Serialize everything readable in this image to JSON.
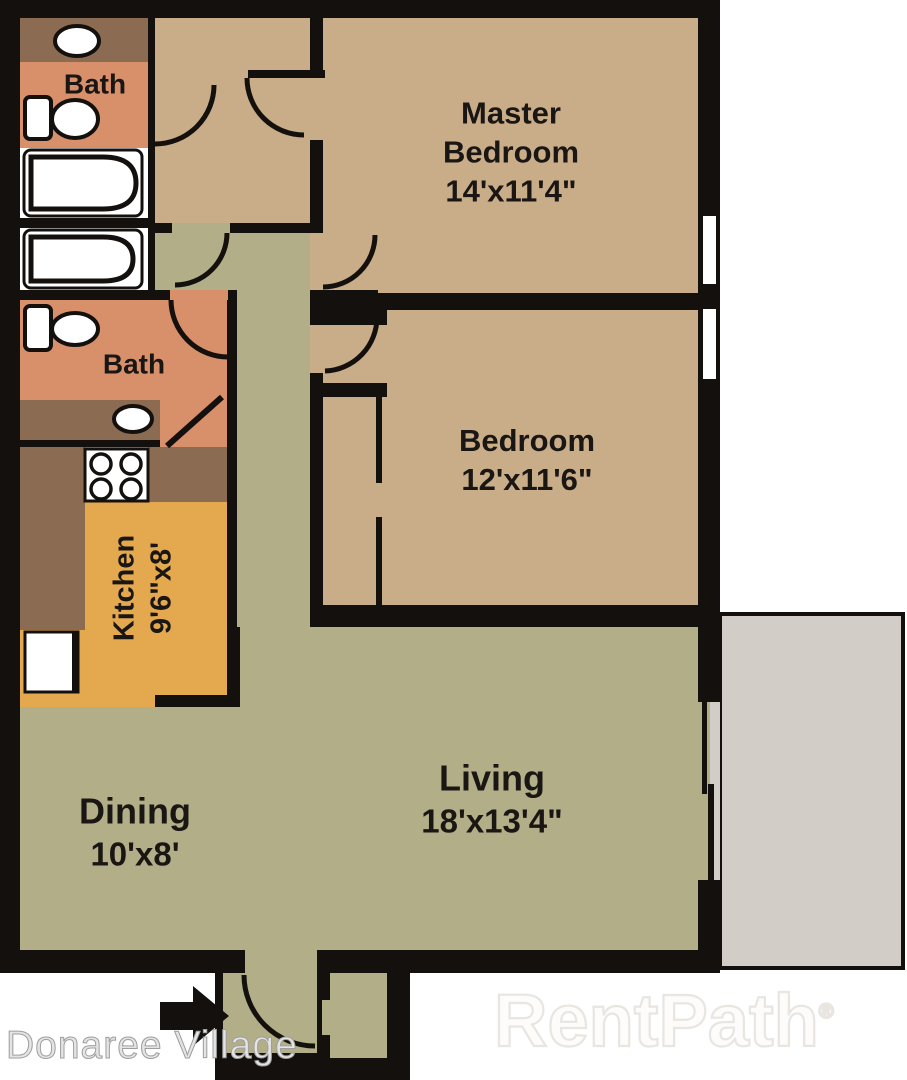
{
  "branding": {
    "community_name": "Donaree Village",
    "watermark": "RentPath",
    "watermark_symbol": "®"
  },
  "rooms": {
    "master_bedroom": {
      "line1": "Master",
      "line2": "Bedroom",
      "dims": "14'x11'4\""
    },
    "bedroom": {
      "name": "Bedroom",
      "dims": "12'x11'6\""
    },
    "living": {
      "name": "Living",
      "dims": "18'x13'4\""
    },
    "dining": {
      "name": "Dining",
      "dims": "10'x8'"
    },
    "kitchen": {
      "name": "Kitchen",
      "dims": "9'6\"x8'"
    },
    "bath_upper": {
      "name": "Bath"
    },
    "bath_lower": {
      "name": "Bath"
    }
  },
  "colors": {
    "wall": "#14100d",
    "tan": "#c9ad89",
    "green": "#b2af88",
    "salmon": "#d8906b",
    "brown": "#8b6c52",
    "orange": "#e4a94e",
    "patio": "#d2cec7",
    "label": "#1a1613"
  }
}
